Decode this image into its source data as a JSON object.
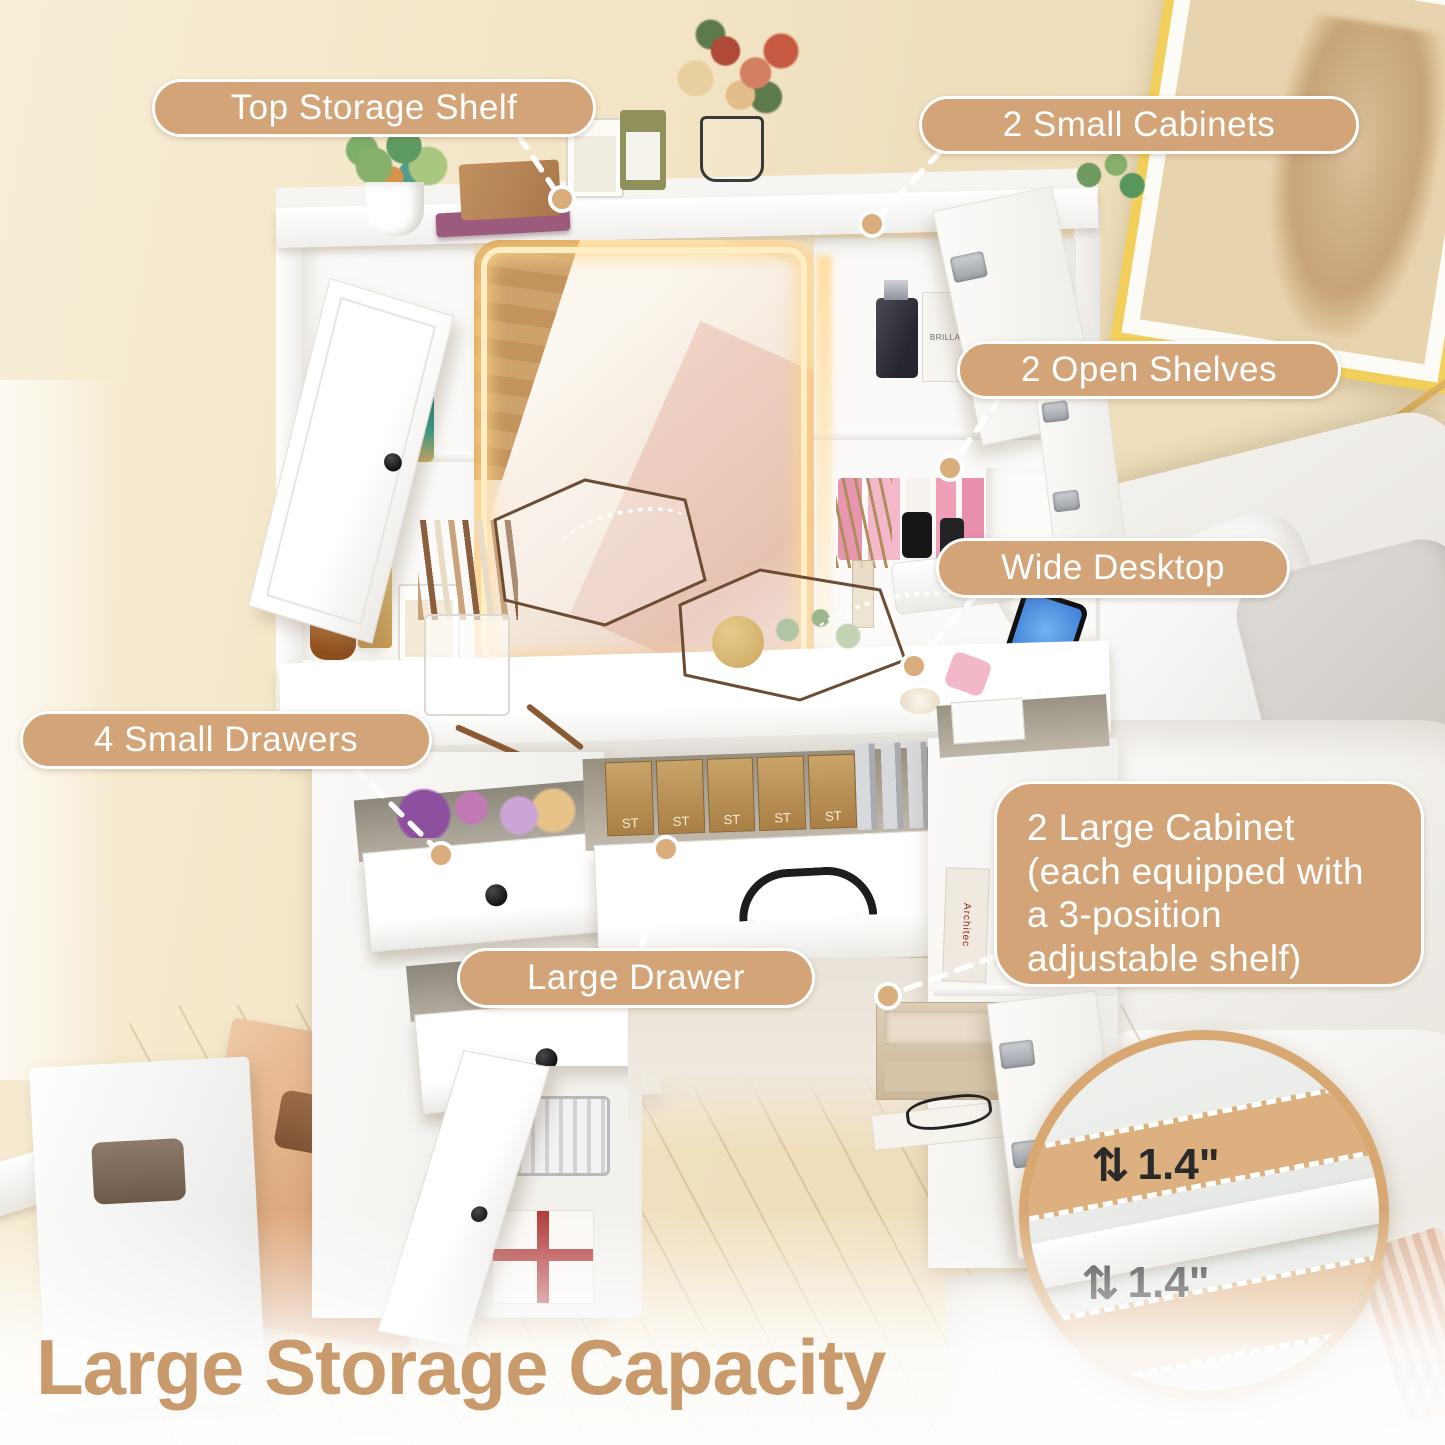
{
  "callouts": {
    "top_storage_shelf": "Top Storage Shelf",
    "small_cabinets": "2 Small Cabinets",
    "open_shelves": "2 Open Shelves",
    "wide_desktop": "Wide Desktop",
    "small_drawers": "4 Small Drawers",
    "large_drawer": "Large Drawer",
    "large_cabinet": "2 Large Cabinet (each equipped with a 3-position adjustable shelf)"
  },
  "inset": {
    "measure_top": "1.4\"",
    "measure_bottom": "1.4\"",
    "arrow_glyph": "⇅"
  },
  "title": "Large Storage Capacity",
  "decor": {
    "st_box_label": "ST",
    "book_label": "Architec",
    "perfume_label": "BRILLANT"
  },
  "colors": {
    "accent": "#D2A478",
    "callout_border": "#FFFFFF",
    "callout_text": "#FFFFFF",
    "title_color": "#C99B6C",
    "led_glow": "#FFD990"
  }
}
